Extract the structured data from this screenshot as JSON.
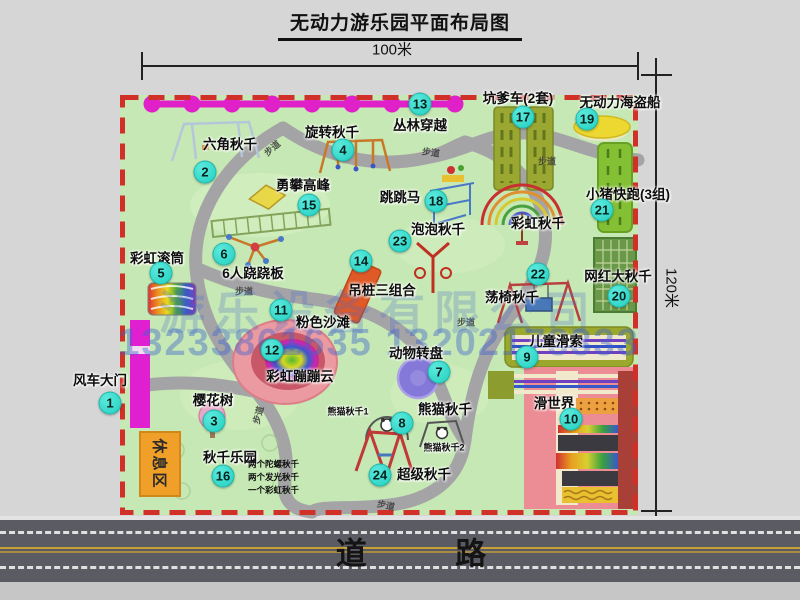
{
  "title": "无动力游乐园平面布局图",
  "dimensions": {
    "top": "100米",
    "right": "120米"
  },
  "road": {
    "label": "道 路"
  },
  "watermark": {
    "company": "游乐设备有限公司",
    "phone": "13233861635 13202178333"
  },
  "map": {
    "border_color": "#d03028",
    "ground_color": "#c6e8b4",
    "badge_color": "#2ed8ca",
    "zipline_color": "#e020c8",
    "gate_color": "#e020d0",
    "path_label": "步道",
    "rest_area": "休息区",
    "pois": [
      {
        "num": "1",
        "label": "风车大门"
      },
      {
        "num": "2",
        "label": "六角秋千"
      },
      {
        "num": "3",
        "label": "樱花树"
      },
      {
        "num": "4",
        "label": "旋转秋千"
      },
      {
        "num": "5",
        "label": "彩虹滚筒"
      },
      {
        "num": "6",
        "label": "6人跷跷板"
      },
      {
        "num": "7",
        "label": "动物转盘"
      },
      {
        "num": "8",
        "label": "熊猫秋千"
      },
      {
        "num": "9",
        "label": "儿童滑索"
      },
      {
        "num": "10",
        "label": "滑世界"
      },
      {
        "num": "11",
        "label": "粉色沙滩"
      },
      {
        "num": "12",
        "label": "彩虹蹦蹦云"
      },
      {
        "num": "13",
        "label": "丛林穿越"
      },
      {
        "num": "14",
        "label": "吊桩三组合"
      },
      {
        "num": "15",
        "label": "勇攀高峰"
      },
      {
        "num": "16",
        "label": "秋千乐园"
      },
      {
        "num": "17",
        "label": "坑爹车(2套)"
      },
      {
        "num": "18",
        "label": "跳跳马"
      },
      {
        "num": "19",
        "label": "无动力海盗船"
      },
      {
        "num": "20",
        "label": "网红大秋千"
      },
      {
        "num": "21",
        "label": "小猪快跑(3组)"
      },
      {
        "num": "22",
        "label": "荡椅秋千"
      },
      {
        "num": "23",
        "label": "泡泡秋千"
      },
      {
        "num": "24",
        "label": "超级秋千"
      }
    ],
    "extras": {
      "rainbow_swing": "彩虹秋千",
      "panda_sub1": "熊猫秋千1",
      "panda_sub2": "熊猫秋千2",
      "swing_park_note1": "两个陀螺秋千",
      "swing_park_note2": "两个发光秋千",
      "swing_park_note3": "一个彩虹秋千"
    }
  }
}
